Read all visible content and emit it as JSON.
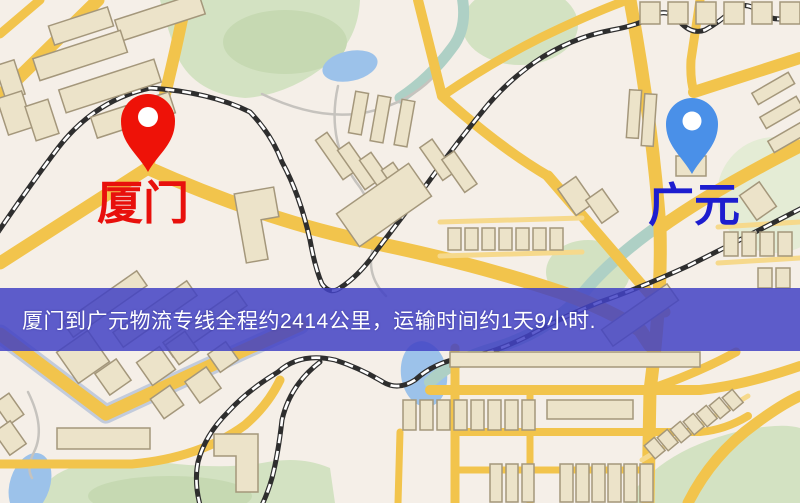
{
  "banner": {
    "text": "厦门到广元物流专线全程约2414公里，运输时间约1天9小时.",
    "bg_color": "#4242c4",
    "text_color": "#ffffff"
  },
  "markers": {
    "origin": {
      "label": "厦门",
      "pin_color": "#ee1208",
      "label_color": "#e8100c"
    },
    "destination": {
      "label": "广元",
      "pin_color": "#4a90e8",
      "label_color": "#1d1dcf"
    }
  },
  "map_colors": {
    "background": "#f5efe8",
    "road_major": "#f2c44c",
    "road_minor": "#f6d98c",
    "building_fill": "#ece3c9",
    "building_stroke": "#a4977b",
    "park": "#d3e2c2",
    "water": "#9cc2ea",
    "river": "#aed0c5",
    "railway": "#2e2e2e"
  }
}
